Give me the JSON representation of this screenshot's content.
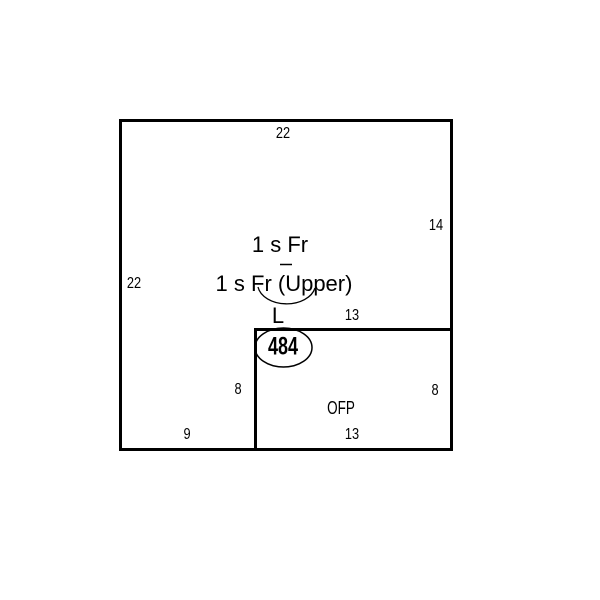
{
  "colors": {
    "background": "#ffffff",
    "line": "#000000"
  },
  "sketch": {
    "labels": {
      "story": "1 s Fr",
      "story_upper": "1 s Fr (Upper)",
      "corner_mark": "L",
      "area_value": "484",
      "porch": "OFP"
    },
    "dims": {
      "top": "22",
      "left": "22",
      "right": "14",
      "porch_top": "13",
      "porch_left": "8",
      "porch_right": "8",
      "porch_bottom": "13",
      "bottom_left": "9"
    }
  }
}
